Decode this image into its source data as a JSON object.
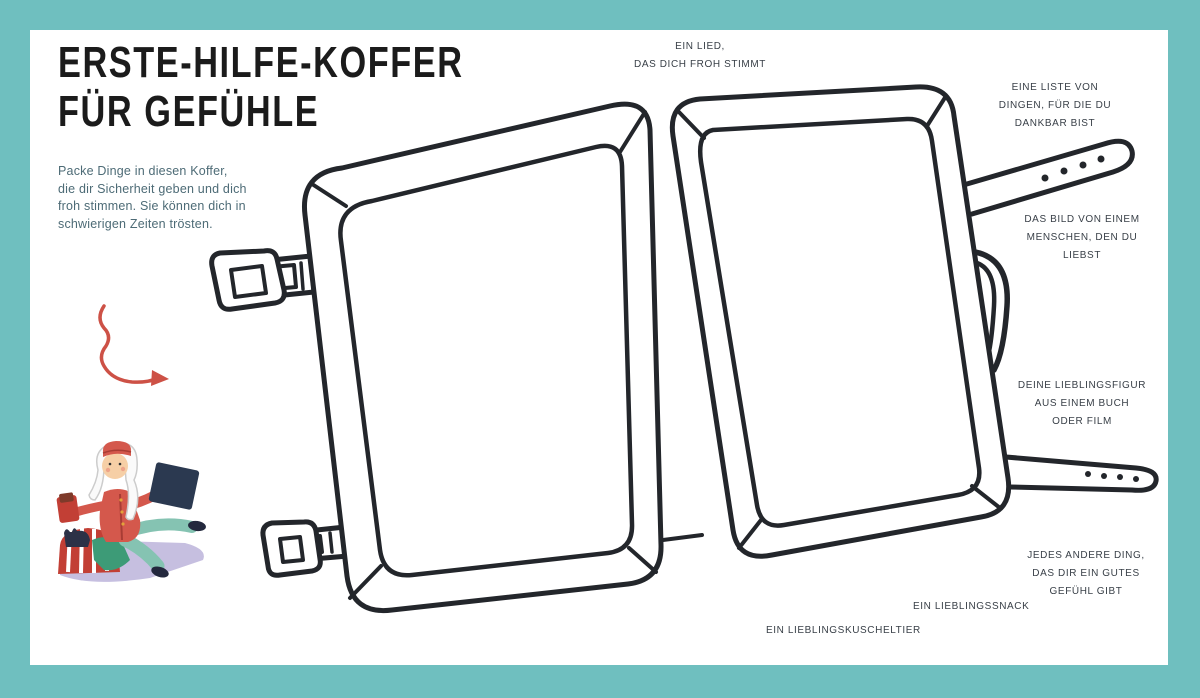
{
  "meta": {
    "language": "de",
    "page_type": "activity-worksheet"
  },
  "colors": {
    "border_teal": "#6fbfbf",
    "paper_white": "#ffffff",
    "outline_ink": "#23262b",
    "title_ink": "#1b1b1b",
    "label_ink": "#383f47",
    "intro_blue": "#4d6b76",
    "accent_red": "#cd5146",
    "jacket_red": "#d4584c",
    "pants_teal": "#85c3b2",
    "book_navy": "#2b3950",
    "blanket_lavender": "#c6bfe0"
  },
  "title": {
    "lines": [
      "ERSTE-HILFE-KOFFER",
      "FÜR GEFÜHLE"
    ]
  },
  "intro": {
    "lines": [
      "Packe Dinge in diesen Koffer,",
      "die dir Sicherheit geben und dich",
      "froh stimmen. Sie können dich in",
      "schwierigen Zeiten trösten."
    ]
  },
  "annotations": {
    "song": {
      "lines": [
        "EIN LIED,",
        "DAS DICH FROH STIMMT"
      ]
    },
    "gratitude_list": {
      "lines": [
        "EINE LISTE VON",
        "DINGEN, FÜR DIE DU",
        "DANKBAR BIST"
      ]
    },
    "photo_loved_one": {
      "lines": [
        "DAS BILD VON EINEM",
        "MENSCHEN, DEN DU",
        "LIEBST"
      ]
    },
    "favorite_figure": {
      "lines": [
        "DEINE LIEBLINGSFIGUR",
        "AUS EINEM BUCH",
        "ODER FILM"
      ]
    },
    "anything_else": {
      "lines": [
        "JEDES ANDERE DING,",
        "DAS DIR EIN GUTES",
        "GEFÜHL GIBT"
      ]
    },
    "favorite_snack": {
      "lines": [
        "EIN LIEBLINGSSNACK"
      ]
    },
    "favorite_plush": {
      "lines": [
        "EIN LIEBLINGSKUSCHELTIER"
      ]
    }
  },
  "illustration": {
    "suitcase": "open-empty-suitcase-outline",
    "hardware": [
      "top-latch",
      "bottom-latch",
      "carry-handle",
      "two-buckle-straps"
    ],
    "arrow": "red-squiggle-arrow",
    "figure": "bellhop-character-sitting-with-packing-items"
  }
}
